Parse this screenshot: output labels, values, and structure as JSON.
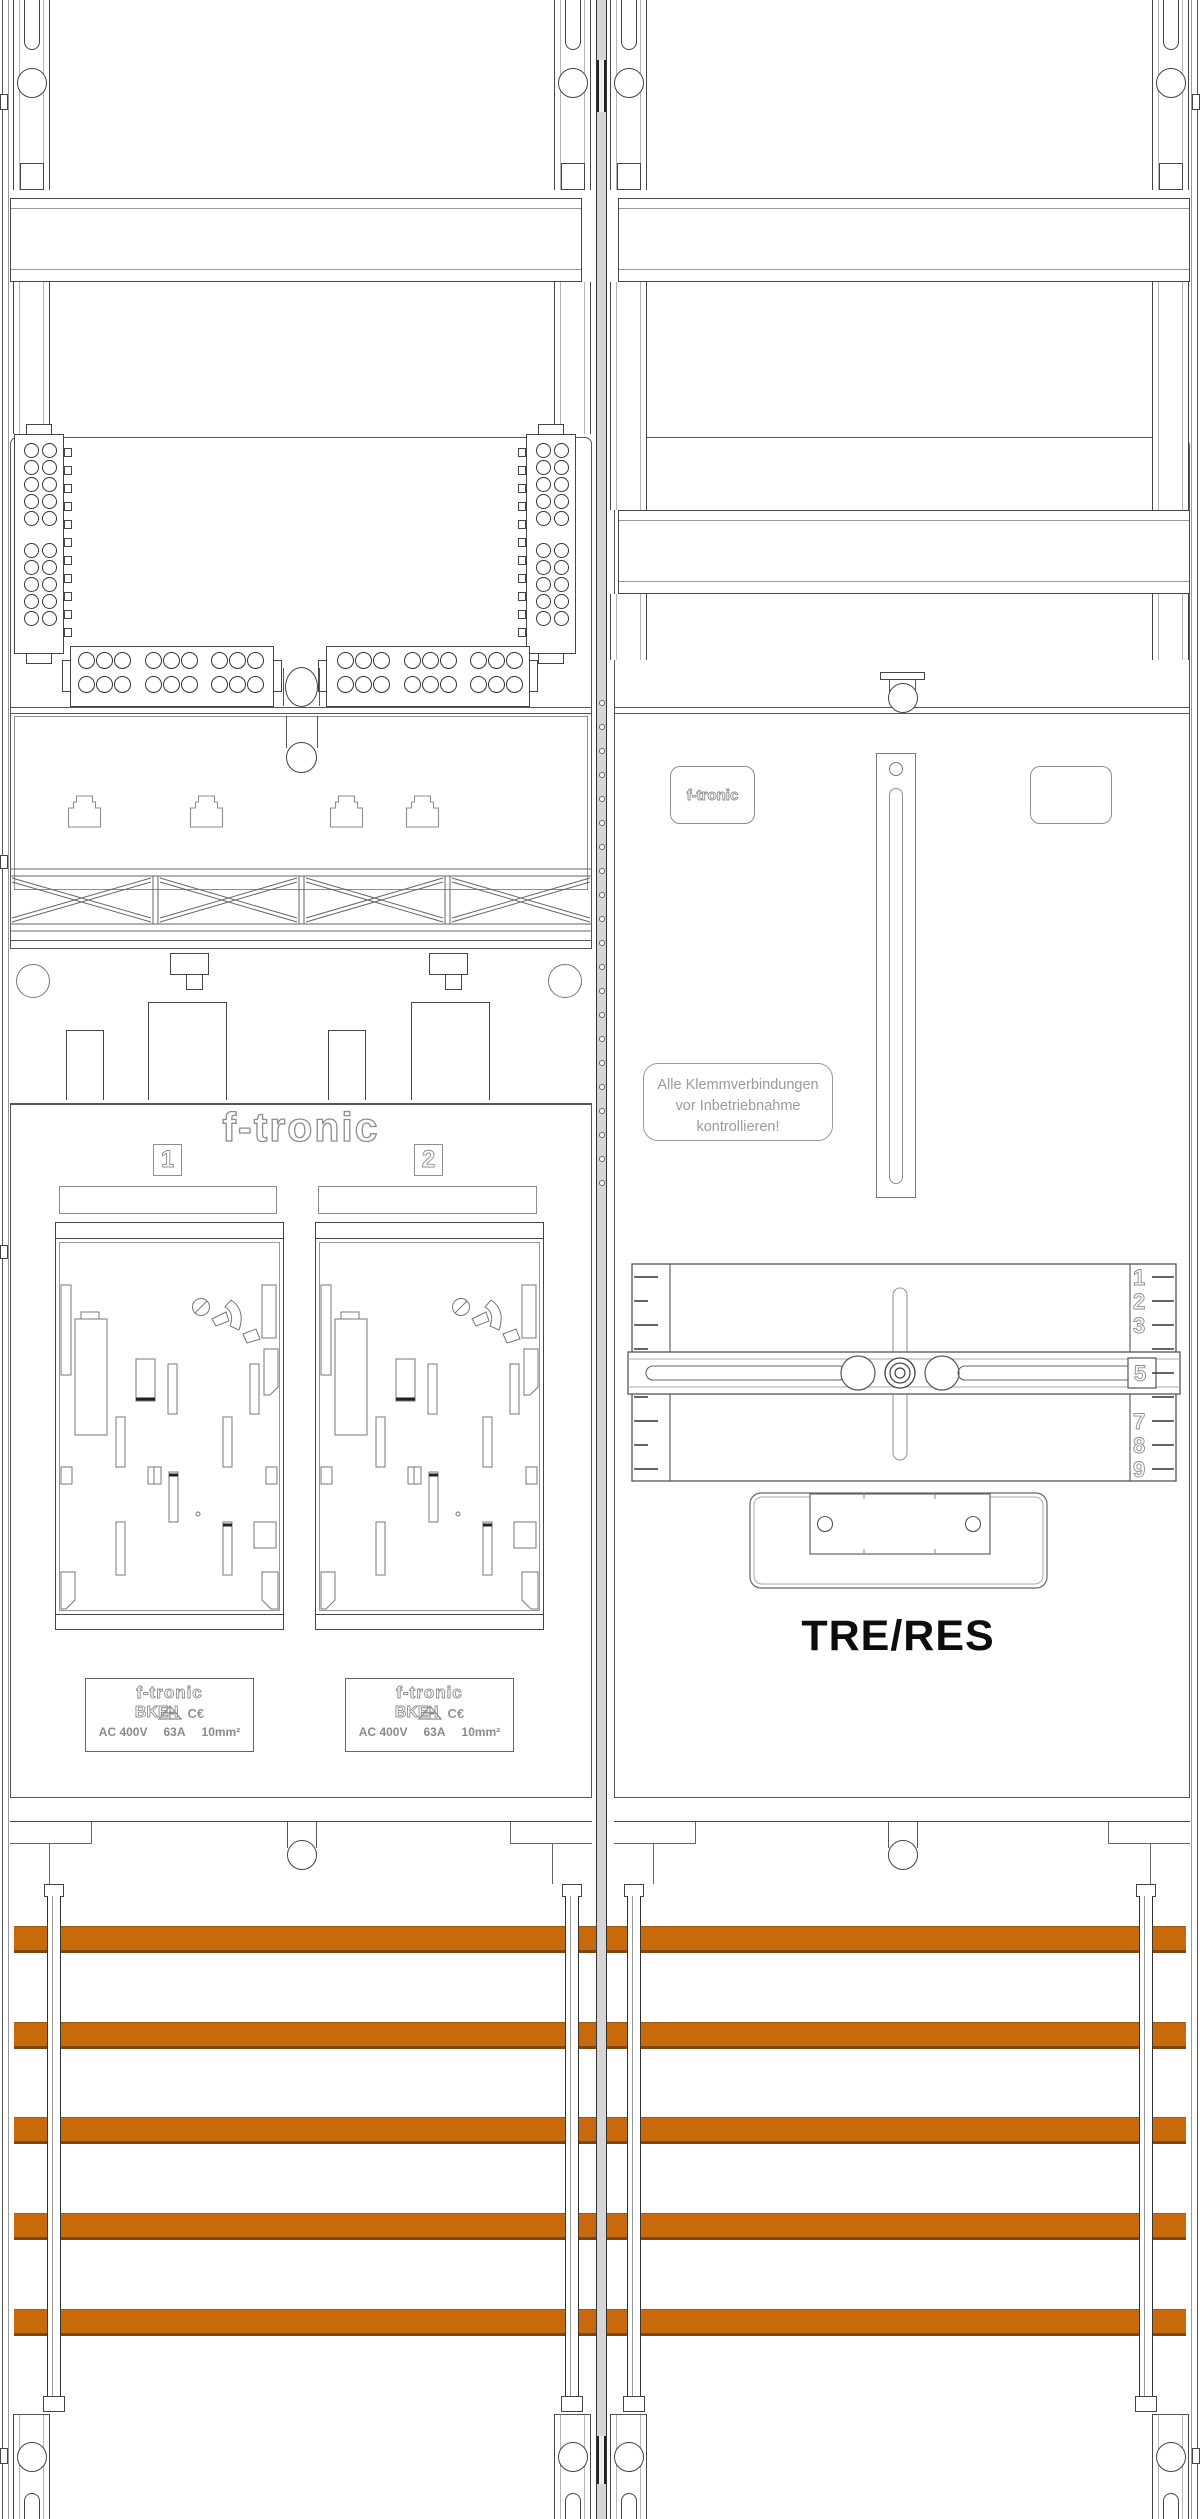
{
  "left_field": {
    "logo": "f-tronic",
    "meters": [
      {
        "position_number": "1",
        "rating_plate": {
          "brand": "f-tronic",
          "model": "BKE-I",
          "ce_mark": "C€",
          "specs": [
            "AC 400V",
            "63A",
            "10mm²"
          ]
        }
      },
      {
        "position_number": "2",
        "rating_plate": {
          "brand": "f-tronic",
          "model": "BKE-I",
          "ce_mark": "C€",
          "specs": [
            "AC 400V",
            "63A",
            "10mm²"
          ]
        }
      }
    ]
  },
  "right_field": {
    "logo_plate": "f-tronic",
    "notice": {
      "lines": [
        "Alle Klemmverbindungen",
        "vor Inbetriebnahme",
        "kontrollieren!"
      ]
    },
    "ruler": {
      "top": [
        "1",
        "2",
        "3"
      ],
      "middle": "5",
      "bottom": [
        "7",
        "8",
        "9"
      ]
    },
    "device_label": "TRE/RES"
  },
  "busbars": {
    "count": 5,
    "color": "#C8690B"
  }
}
